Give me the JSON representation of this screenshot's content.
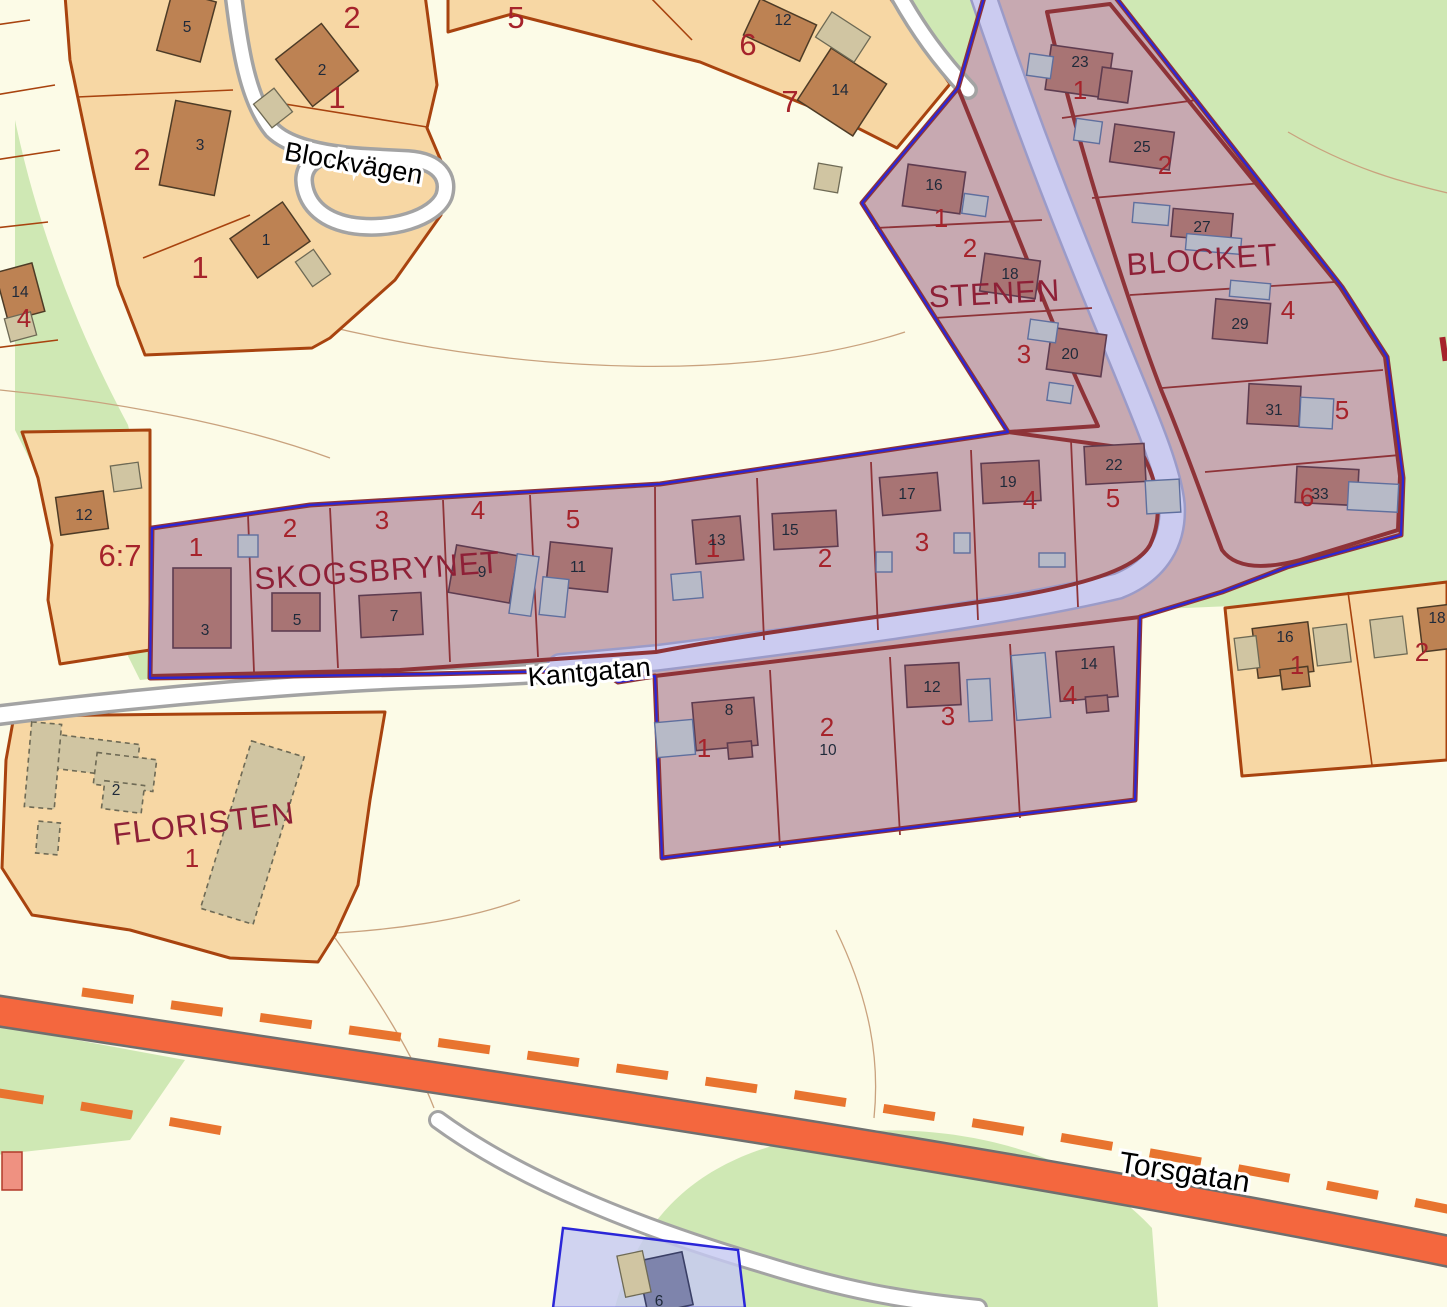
{
  "palette": {
    "green": "#cfe8b4",
    "cream": "#fcfbe7",
    "orange": "#f7d7a4",
    "orange_border": "#a8430f",
    "purple": "#c7a9b1",
    "purple_road": "#cbcbf0",
    "purple_road_casing": "#9b9bc8",
    "blue_boundary": "#2b26d8",
    "block_border": "#8e3338",
    "road_fill": "#ffffff",
    "road_casing": "#a3a3a3",
    "torsgatan_fill": "#f4673e",
    "torsgatan_casing": "#6f6f6f",
    "torsgatan_dash": "#e8742f",
    "bldg_brown": "#bd8253",
    "bldg_brown_border": "#4d3b26",
    "bldg_tan": "#d0c5a2",
    "bldg_tan_border": "#6e6a55",
    "bldg_purple": "#a87474",
    "bldg_purple_border": "#5e3c50",
    "bldg_gray": "#b7bac7",
    "bldg_gray_border": "#5f6f9e",
    "bldg_blue": "#7e84ac",
    "label_red": "#a6232b",
    "label_block": "#8e2037",
    "label_dark": "#1f2a3a",
    "contour": "#c9a27e"
  },
  "streets": {
    "blockvagen": "Blockvägen",
    "kantgatan": "Kantgatan",
    "torsgatan": "Torsgatan"
  },
  "blocks": {
    "stenen": "STENEN",
    "blocket": "BLOCKET",
    "skogsbrynet": "SKOGSBRYNET",
    "floristen": "FLORISTEN"
  },
  "lots": {
    "bv_west": "2",
    "bv_south": "1",
    "bv_north": "2",
    "bv_ne": "1",
    "top_5": "5",
    "top_6": "6",
    "top_7": "7",
    "west_edge": "4",
    "parcel67": "6:7",
    "floristen": "1",
    "east_1": "1",
    "east_2": "2",
    "stenen_1": "1",
    "stenen_2": "2",
    "stenen_3": "3",
    "blocket_1": "1",
    "blocket_2": "2",
    "blocket_4": "4",
    "blocket_5": "5",
    "blocket_6": "6",
    "skw_1": "1",
    "skw_2": "2",
    "skw_3": "3",
    "skw_4": "4",
    "skw_5": "5",
    "ske_1": "1",
    "ske_2": "2",
    "ske_3": "3",
    "ske_4": "4",
    "ske_5": "5",
    "south_1": "1",
    "south_2": "2",
    "south_3": "3",
    "south_4": "4"
  },
  "buildings": {
    "bv5": "5",
    "bv3": "3",
    "bv2": "2",
    "bv1": "1",
    "top12": "12",
    "top14": "14",
    "edge14": "14",
    "p67": "12",
    "floristen2": "2",
    "e16": "16",
    "e18": "18",
    "st16": "16",
    "st18": "18",
    "st20": "20",
    "bl23": "23",
    "bl25": "25",
    "bl27": "27",
    "bl29": "29",
    "bl31": "31",
    "bl33": "33",
    "skw3": "3",
    "skw5": "5",
    "skw7": "7",
    "skw9": "9",
    "skw11": "11",
    "ske13": "13",
    "ske15": "15",
    "ske17": "17",
    "ske19": "19",
    "ske22": "22",
    "s8": "8",
    "s10": "10",
    "s12": "12",
    "s14": "14",
    "blue6": "6"
  }
}
